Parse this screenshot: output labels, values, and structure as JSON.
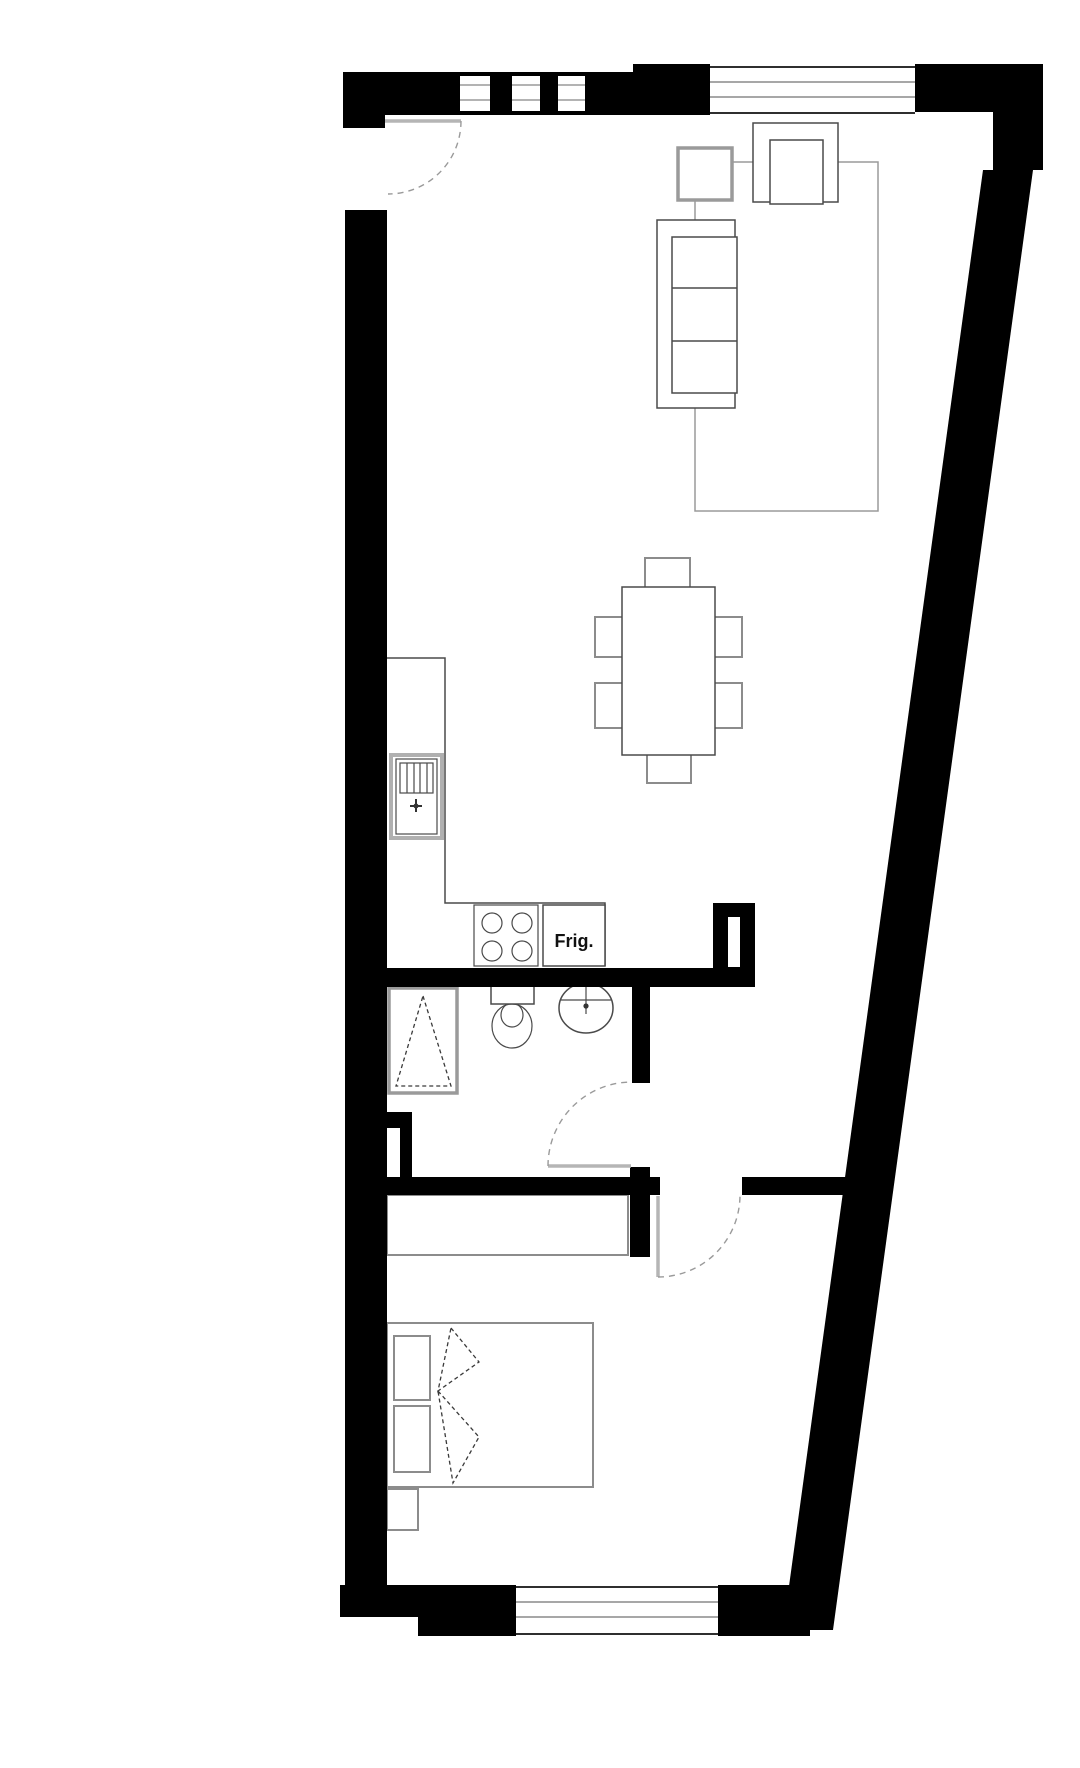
{
  "plan": {
    "type": "apartment-floor-plan",
    "background": "#ffffff",
    "labels": {
      "fridge": "Frig."
    },
    "palette": {
      "wall": "#000000",
      "fixture_line": "#4a4a4a",
      "furniture_line": "#8c8c8c",
      "door_swing": "#9a9a9a",
      "window_line": "#2f2f2f",
      "label_text": "#111111"
    },
    "counts": {
      "dining_chairs": 6,
      "sofa_cushions": 3,
      "stove_burners": 4,
      "bed_pillows": 2,
      "top_small_window_panes": 3,
      "top_right_window_glazing_lines": 2,
      "bottom_window_glazing_lines": 2,
      "doors_with_swing_arcs": 3
    },
    "elements": [
      "entry-door",
      "top-small-window",
      "top-right-window",
      "slanted-right-wall",
      "armchair",
      "side-table",
      "sofa",
      "area-rug",
      "dining-table",
      "dining-chairs",
      "kitchen-counter",
      "kitchen-sink",
      "stove",
      "refrigerator",
      "duct-shaft",
      "shower",
      "toilet",
      "wash-basin",
      "bathroom-door",
      "bedroom-door",
      "wardrobe",
      "double-bed",
      "pillows",
      "blanket-fold",
      "nightstand",
      "bottom-window"
    ]
  }
}
